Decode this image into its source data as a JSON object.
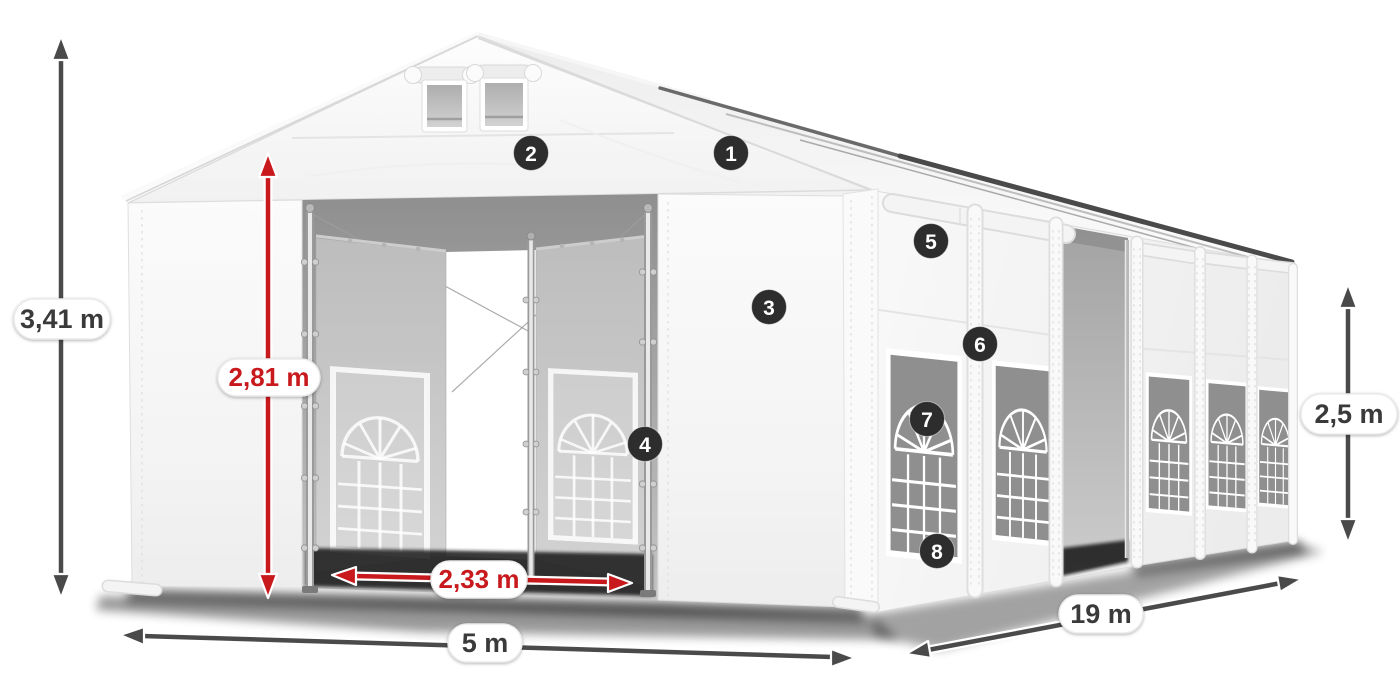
{
  "colors": {
    "background": "#ffffff",
    "dimension_red": "#c8191d",
    "dimension_gray": "#4a4a4a",
    "badge_bg": "#2d2d2d",
    "badge_text": "#ffffff",
    "label_bg": "#ffffff",
    "label_text": "#3a3a3a"
  },
  "dimensions": {
    "total_height": "3,41 m",
    "entrance_height": "2,81 m",
    "entrance_width": "2,33 m",
    "width": "5 m",
    "length": "19 m",
    "side_height": "2,5 m"
  },
  "markers": [
    {
      "number": "1"
    },
    {
      "number": "2"
    },
    {
      "number": "3"
    },
    {
      "number": "4"
    },
    {
      "number": "5"
    },
    {
      "number": "6"
    },
    {
      "number": "7"
    },
    {
      "number": "8"
    }
  ]
}
